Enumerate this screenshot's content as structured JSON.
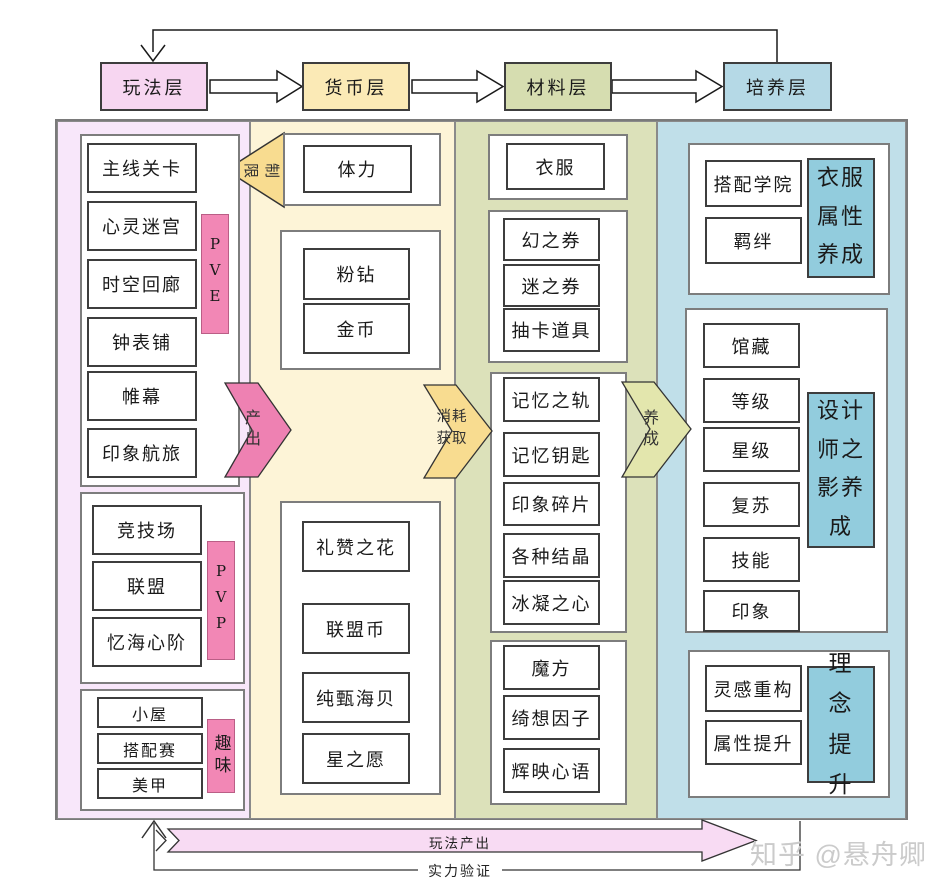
{
  "watermark": "知乎 @悬舟卿",
  "header": {
    "layers": [
      {
        "label": "玩法层",
        "color": "#f7d6f1"
      },
      {
        "label": "货币层",
        "color": "#fbeab6"
      },
      {
        "label": "材料层",
        "color": "#d6ddb0"
      },
      {
        "label": "培养层",
        "color": "#b5d9e6"
      }
    ]
  },
  "arrows": {
    "restrict_chars": [
      "限",
      "制"
    ],
    "produce": "产出",
    "consume": "消耗获取",
    "train": "养成",
    "bottom_produce": "玩法产出",
    "bottom_verify": "实力验证"
  },
  "columns": {
    "gameplay": {
      "bg": "#f8e7fa",
      "groups": [
        {
          "tag": "PVE",
          "items": [
            "主线关卡",
            "心灵迷宫",
            "时空回廊",
            "钟表铺",
            "帷幕",
            "印象航旅"
          ]
        },
        {
          "tag": "PVP",
          "items": [
            "竞技场",
            "联盟",
            "忆海心阶"
          ]
        },
        {
          "tag": "趣味",
          "items": [
            "小屋",
            "搭配赛",
            "美甲"
          ]
        }
      ]
    },
    "currency": {
      "bg": "#fdf4d7",
      "groups": [
        {
          "items": [
            "体力"
          ]
        },
        {
          "items": [
            "粉钻",
            "金币"
          ]
        },
        {
          "items": [
            "礼赞之花",
            "联盟币",
            "纯甄海贝",
            "星之愿"
          ]
        }
      ]
    },
    "material": {
      "bg": "#dce1ba",
      "groups": [
        {
          "items": [
            "衣服"
          ]
        },
        {
          "items": [
            "幻之券",
            "迷之券",
            "抽卡道具"
          ]
        },
        {
          "items": [
            "记忆之轨",
            "记忆钥匙",
            "印象碎片",
            "各种结晶",
            "冰凝之心"
          ]
        },
        {
          "items": [
            "魔方",
            "绮想因子",
            "辉映心语"
          ]
        }
      ]
    },
    "training": {
      "bg": "#c0dfe9",
      "groups": [
        {
          "tag": "衣服属性养成",
          "items": [
            "搭配学院",
            "羁绊"
          ]
        },
        {
          "tag": "设计师之影养成",
          "items": [
            "馆藏",
            "等级",
            "星级",
            "复苏",
            "技能",
            "印象"
          ]
        },
        {
          "tag": "理念提升",
          "items": [
            "灵感重构",
            "属性提升"
          ]
        }
      ]
    }
  }
}
